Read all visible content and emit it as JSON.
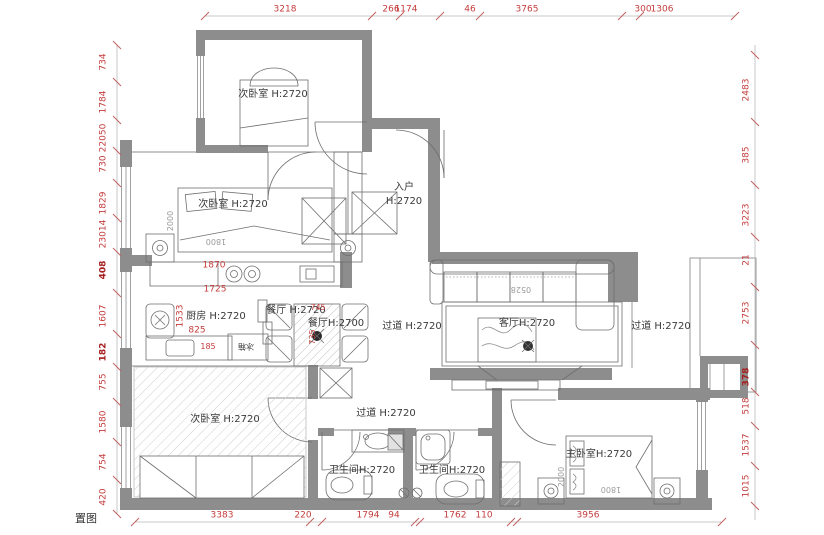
{
  "meta": {
    "sheet_title_partial": "置图"
  },
  "colors": {
    "wall": "#8d8d8d",
    "dim_red": "#c43c3c",
    "ink": "#3a3a3a"
  },
  "rooms": {
    "bedroom_top": "次卧室 H:2720",
    "bedroom_mid": "次卧室 H:2720",
    "bedroom_bottom": "次卧室 H:2720",
    "master_bedroom": "主卧室H:2720",
    "kitchen": "厨房 H:2720",
    "dining_a": "餐厅 H:2720",
    "dining_b": "餐厅H:2700",
    "entry_line1": "入户",
    "entry_line2": "H:2720",
    "hall_mid": "过道 H:2720",
    "hall_right": "过道 H:2720",
    "hall_low": "过道 H:2720",
    "living": "客厅H:2720",
    "bath_left": "卫生间H:2720",
    "bath_right": "卫生间H:2720"
  },
  "furniture": {
    "fridge": "冰箱",
    "sofa_code": "0528",
    "bed_mid_width": "1800",
    "bed_mid_length": "2000",
    "bed_master_width": "1800",
    "bed_master_length": "2000"
  },
  "dims": {
    "top": [
      "3218",
      "266",
      "1174",
      "46",
      "3765",
      "300",
      "1306"
    ],
    "bottom": [
      "3383",
      "220",
      "1794",
      "94",
      "1762",
      "110",
      "3956"
    ],
    "left": [
      "734",
      "1784",
      "22050",
      "730",
      "1829",
      "23014",
      "408",
      "1607",
      "182",
      "755",
      "1580",
      "754",
      "420"
    ],
    "right": [
      "2483",
      "385",
      "3223",
      "21",
      "2753",
      "378",
      "518",
      "1537",
      "1015"
    ],
    "inner": {
      "kitchen_1870": "1870",
      "kitchen_1725": "1725",
      "kitchen_1533": "1533",
      "kitchen_825": "825",
      "kitchen_185": "185",
      "dining_745": "745",
      "dining_735": "735"
    }
  }
}
